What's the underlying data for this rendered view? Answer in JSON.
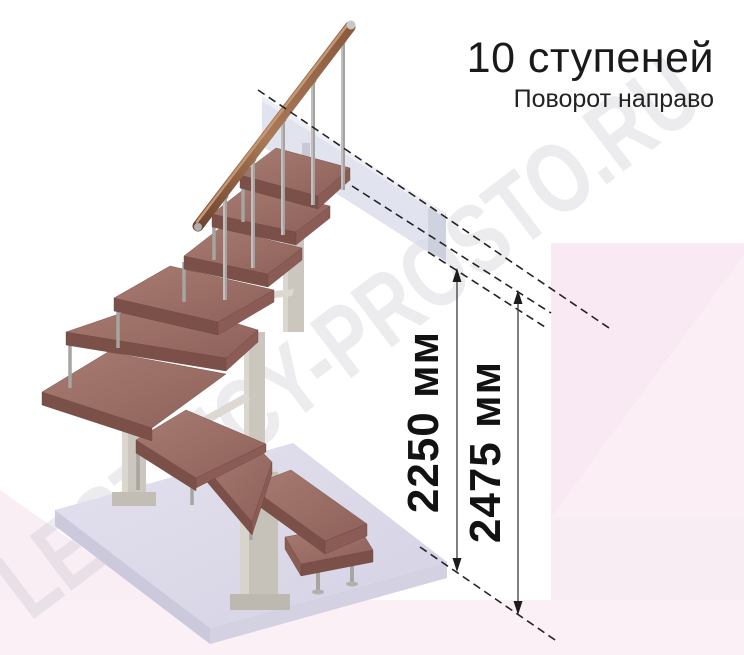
{
  "header": {
    "title": "10 ступеней",
    "subtitle": "Поворот направо"
  },
  "dimensions": {
    "inner": "2250 мм",
    "outer": "2475 мм"
  },
  "watermark": "LESTNICY-PROSTO.RU",
  "stair": {
    "steps_count": "10",
    "turn_direction": "направо",
    "type": "модульная лестница с поворотом"
  },
  "colors": {
    "wood_top": "#9c6f67",
    "wood_front": "#7b5049",
    "wood_side": "#8a5c55",
    "handrail": "#96663f",
    "metal": "#a7a4a1",
    "mast": "#cbc7bf",
    "floor_top": "#dcd9e8",
    "floor_front": "#ccc9dc",
    "panel": "#d5d9e8",
    "panel_end": "#c7cad9",
    "pink_block": "#f8e9f2",
    "pink_soft": "#faeef5",
    "dimension_line": "#3b3b3b",
    "watermark_gray": "#c5c0ca",
    "title_color": "#1a1a1a"
  }
}
